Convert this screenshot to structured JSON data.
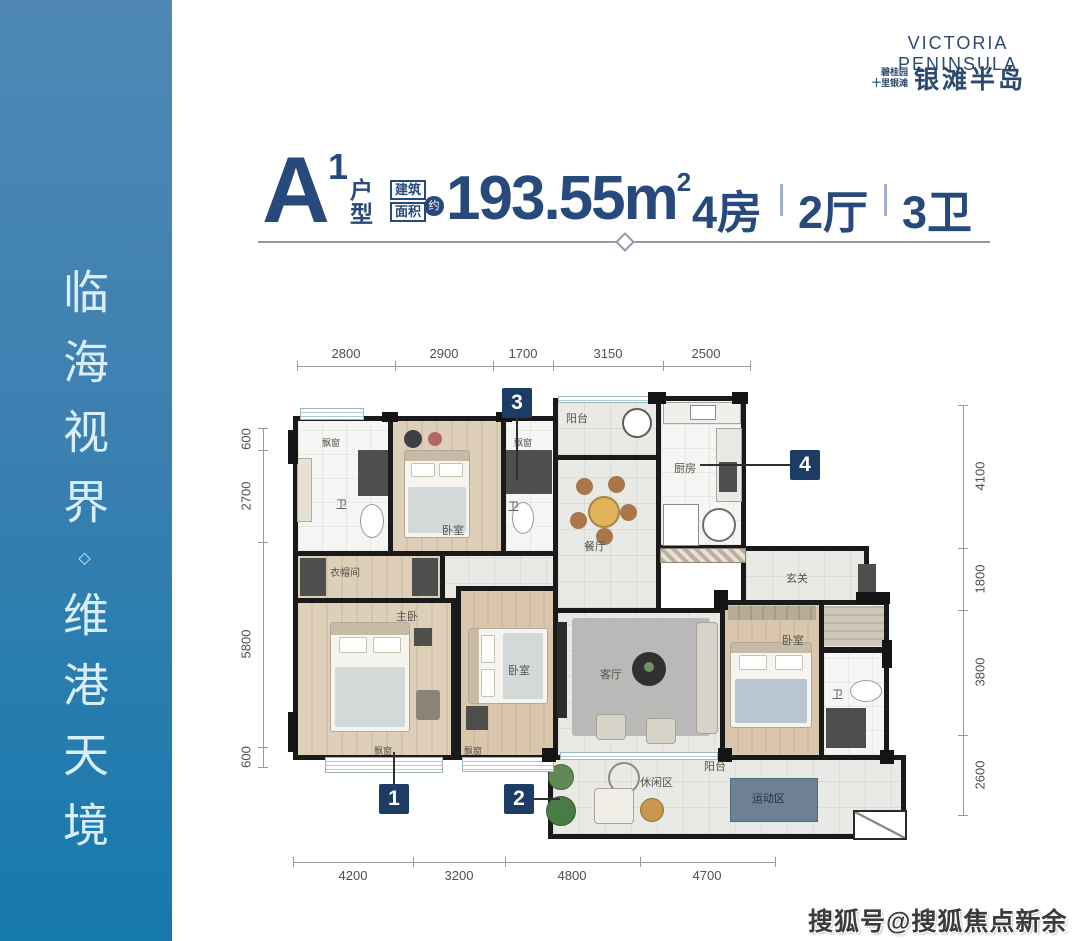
{
  "brand": {
    "name_en": "VICTORIA PENINSULA",
    "tagline_line1": "碧桂园",
    "tagline_line2": "十里银滩",
    "name_cn": "银滩半岛"
  },
  "sidebar": {
    "slogan_part1": "临海视界",
    "divider": "◇",
    "slogan_part2": "维港天境"
  },
  "title": {
    "plan_letter": "A",
    "plan_sup": "1",
    "plan_char1": "户",
    "plan_char2": "型",
    "area_label1": "建筑",
    "area_label2": "面积",
    "area_approx": "约",
    "area_value": "193.55m",
    "area_unit_sup": "2",
    "spec_rooms": "4房",
    "spec_halls": "2厅",
    "spec_baths": "3卫"
  },
  "floorplan": {
    "dims_top": [
      "2800",
      "2900",
      "1700",
      "3150",
      "2500"
    ],
    "dims_left": [
      "600",
      "2700",
      "5800",
      "600"
    ],
    "dims_right": [
      "4100",
      "1800",
      "3800",
      "2600"
    ],
    "dims_bottom": [
      "4200",
      "3200",
      "4800",
      "4700"
    ],
    "markers": {
      "m1": "1",
      "m2": "2",
      "m3": "3",
      "m4": "4"
    },
    "rooms": {
      "bay_window_1": "飘窗",
      "bath_1": "卫",
      "bedroom_top": "卧室",
      "bay_window_2": "飘窗",
      "bath_2": "卫",
      "balcony_top": "阳台",
      "kitchen": "厨房",
      "dining": "餐厅",
      "closet": "衣帽间",
      "master_bedroom": "主卧",
      "bedroom_mid": "卧室",
      "living": "客厅",
      "foyer": "玄关",
      "bedroom_right": "卧室",
      "bath_3": "卫",
      "bay_window_3": "飘窗",
      "bay_window_4": "飘窗",
      "balcony_bottom": "阳台",
      "leisure_zone": "休闲区",
      "sport_zone": "运动区"
    }
  },
  "watermark": {
    "text": "搜狐号@搜狐焦点新余站"
  }
}
